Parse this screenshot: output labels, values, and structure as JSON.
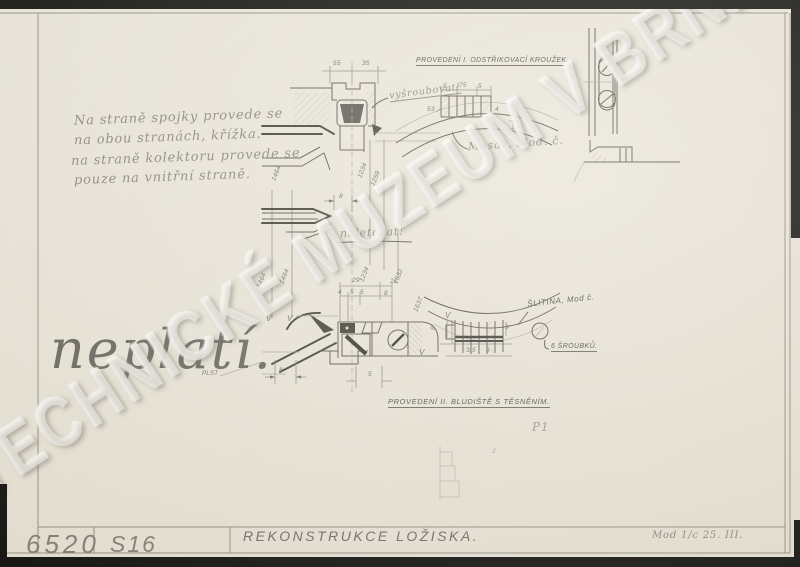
{
  "watermark": {
    "text": "TECHNICKÉ MUZEUM V BRNĚ"
  },
  "titleblock": {
    "number": "6520",
    "code": "S16",
    "title": "REKONSTRUKCE LOŽISKA.",
    "note": "Mod 1/c 25. III."
  },
  "headings": {
    "version1": "PROVEDENÍ I.  ODSTŘIKOVACÍ KROUŽEK.",
    "version2": "PROVEDENÍ II.  BLUDIŠTĚ S TĚSNĚNÍM."
  },
  "labels": {
    "material1": "Mosaz, Mod. č.",
    "material2": "ŠLITINA, Mod č.",
    "screws": "6 ŠROUBKŮ.",
    "unscrew": "vyšroubovat!",
    "solder": "naletovat!",
    "felt": "PLST",
    "p1": "P1"
  },
  "handnote": {
    "line1": "Na straně spojky provede se",
    "line2": "na obou stranách, křížka.",
    "line3": "na straně kolektoru provede se",
    "line4": "pouze na vnitřní straně.",
    "invalid": "neplatí."
  },
  "dims": {
    "d1": "55",
    "d2": "35",
    "d3": "8",
    "d4": "29",
    "d5": "11",
    "d6": "4",
    "d7": "5",
    "d8": "5",
    "d9": "8",
    "d10": "8",
    "d11": "5",
    "d12": "5",
    "d13": "75",
    "d14": "5",
    "d15": "53",
    "d16": "4",
    "d17": "8",
    "d18": "9",
    "d19": "3,5",
    "d20": "8",
    "d21": "2.",
    "m1": "V",
    "m2": "V",
    "m3": "V",
    "m4": "V",
    "r1": "1464",
    "r2": "1234",
    "r3": "1259",
    "r4": "1464",
    "r5": "1464",
    "r6": "1234",
    "r7": "1632",
    "r8": "1637"
  }
}
